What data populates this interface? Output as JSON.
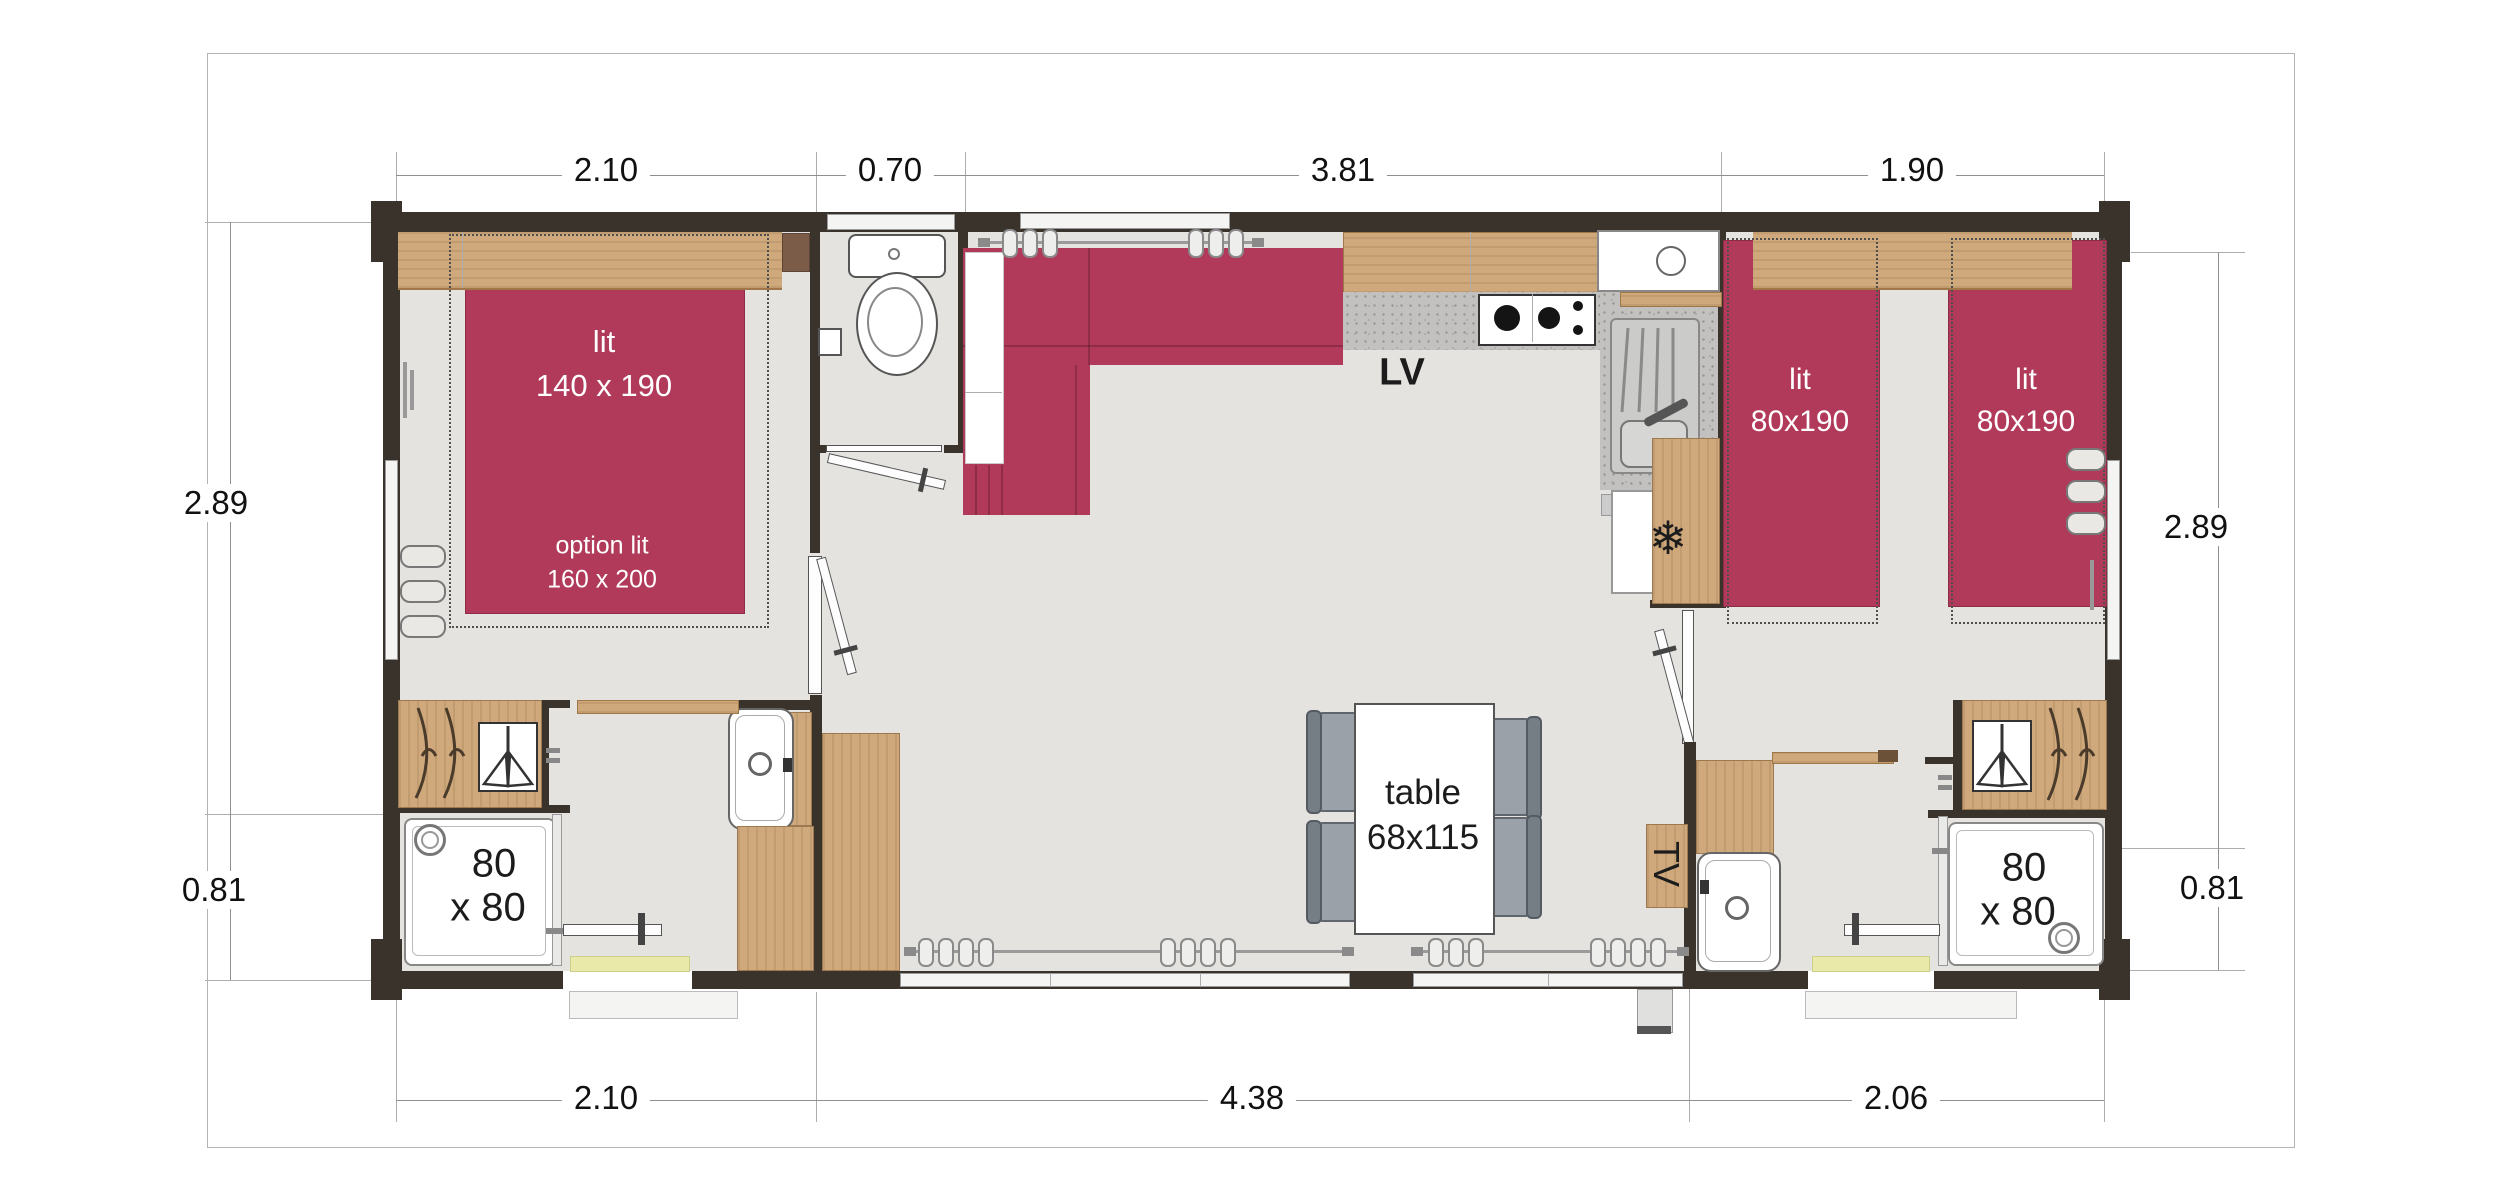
{
  "plan_title": "mobile-home floor plan",
  "colors": {
    "wall": "#3a332c",
    "bed_crimson": "#b13a5a",
    "wood": "#cfa97c",
    "floor": "#e4e3df",
    "granite_counter": "#c2c1bf",
    "door_mat": "#e9eaa9",
    "chair_gray": "#9aa1a8"
  },
  "dimensions": {
    "top": [
      "2.10",
      "0.70",
      "3.81",
      "1.90"
    ],
    "bottom": [
      "2.10",
      "4.38",
      "2.06"
    ],
    "left": [
      "2.89",
      "0.81"
    ],
    "right": [
      "2.89",
      "0.81"
    ]
  },
  "labels": {
    "master_bed_line1": "lit",
    "master_bed_line2": "140 x 190",
    "master_option_line1": "option lit",
    "master_option_line2": "160 x 200",
    "twin_bed_line1": "lit",
    "twin_bed_line2": "80x190",
    "shower_line1": "80",
    "shower_line2": "x 80",
    "table_line1": "table",
    "table_line2": "68x115",
    "dishwasher": "LV",
    "tv": "TV",
    "freezer_icon": "❄"
  }
}
